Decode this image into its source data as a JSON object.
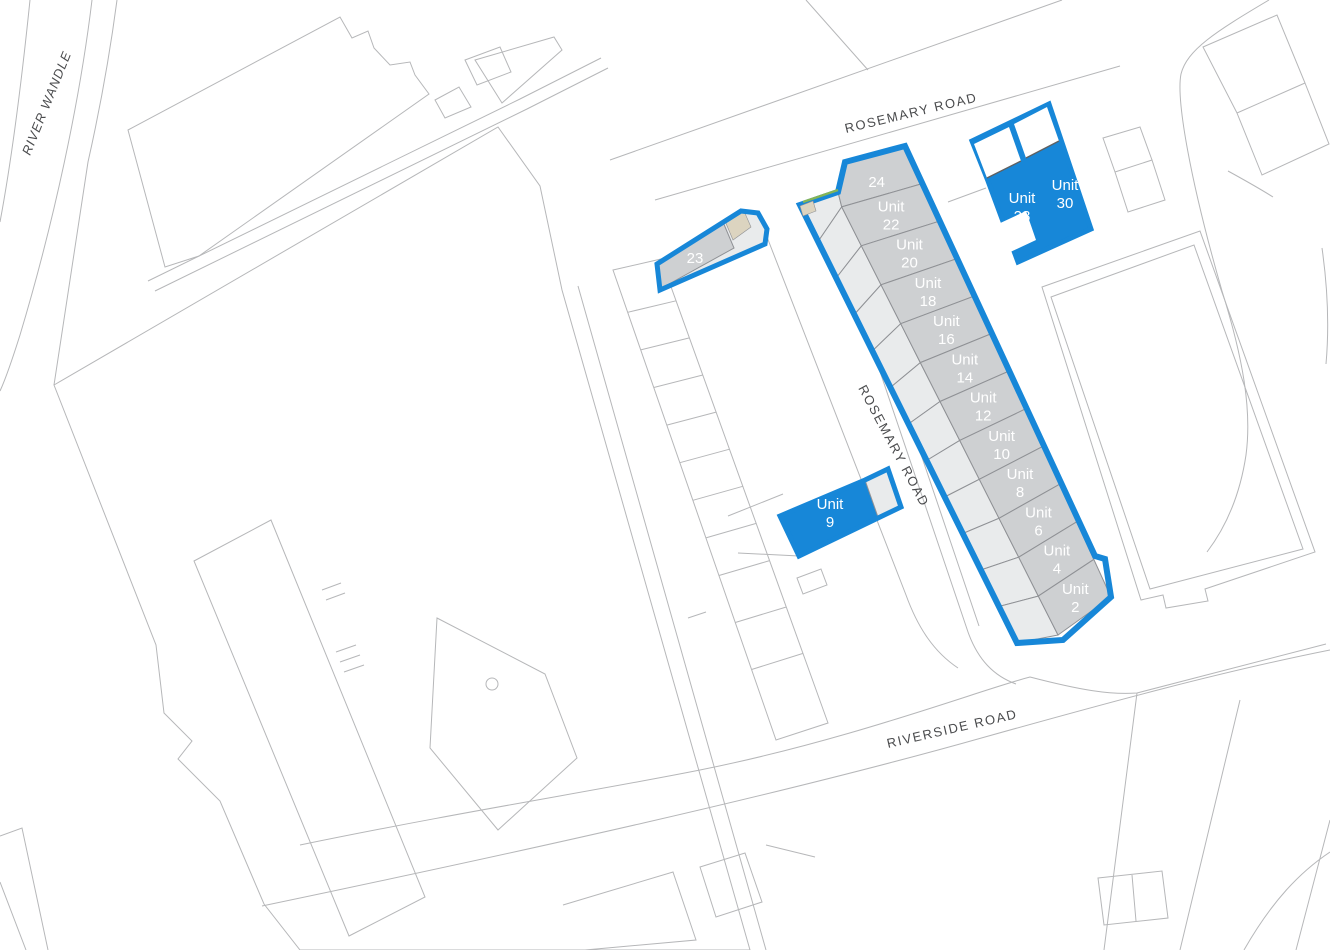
{
  "map": {
    "colors": {
      "highlight": "#1787d8",
      "unit_dark": "#ced0d2",
      "unit_light": "#e9ebec",
      "beige": "#dcd4c0",
      "green": "#84b457",
      "outline": "#b6b7b9",
      "divider": "#8f9195",
      "label_dark": "#4a4b4d"
    },
    "roads": {
      "rosemary_top": {
        "label": "ROSEMARY ROAD"
      },
      "rosemary_mid": {
        "label": "ROSEMARY ROAD"
      },
      "riverside": {
        "label": "RIVERSIDE ROAD"
      },
      "river": {
        "label": "RIVER WANDLE"
      }
    },
    "terrace_units": [
      {
        "id": "unit-24",
        "lines": [
          "24"
        ]
      },
      {
        "id": "unit-22",
        "lines": [
          "Unit",
          "22"
        ]
      },
      {
        "id": "unit-20",
        "lines": [
          "Unit",
          "20"
        ]
      },
      {
        "id": "unit-18",
        "lines": [
          "Unit",
          "18"
        ]
      },
      {
        "id": "unit-16",
        "lines": [
          "Unit",
          "16"
        ]
      },
      {
        "id": "unit-14",
        "lines": [
          "Unit",
          "14"
        ]
      },
      {
        "id": "unit-12",
        "lines": [
          "Unit",
          "12"
        ]
      },
      {
        "id": "unit-10",
        "lines": [
          "Unit",
          "10"
        ]
      },
      {
        "id": "unit-8",
        "lines": [
          "Unit",
          "8"
        ]
      },
      {
        "id": "unit-6",
        "lines": [
          "Unit",
          "6"
        ]
      },
      {
        "id": "unit-4",
        "lines": [
          "Unit",
          "4"
        ]
      },
      {
        "id": "unit-2",
        "lines": [
          "Unit",
          "2"
        ]
      }
    ],
    "detached_units": [
      {
        "id": "unit-23",
        "lines": [
          "23"
        ]
      },
      {
        "id": "unit-9",
        "lines": [
          "Unit",
          "9"
        ]
      },
      {
        "id": "unit-28",
        "lines": [
          "Unit",
          "28"
        ]
      },
      {
        "id": "unit-30",
        "lines": [
          "Unit",
          "30"
        ]
      }
    ]
  }
}
